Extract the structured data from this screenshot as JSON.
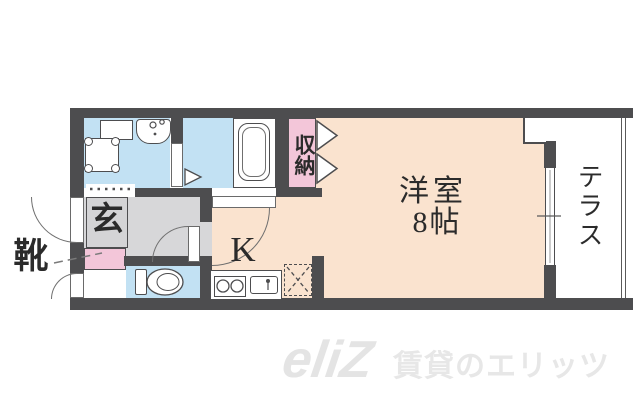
{
  "floorplan": {
    "labels": {
      "entrance": "玄",
      "shoes": "靴",
      "storage": "収納",
      "room_name": "洋室",
      "room_size": "8帖",
      "kitchen": "K",
      "terrace": "テラス"
    },
    "colors": {
      "wall": "#4d4d4f",
      "water_rooms_blue": "#c2e1f3",
      "closet_pink": "#f3c6d9",
      "main_room_cream": "#fae3cf",
      "hall_gray": "#d7d7d9",
      "label_ink": "#2b2b2b",
      "watermark_gray": "#e7e7e7"
    },
    "icons": [
      "washer-pan-icon",
      "washroom-sink-icon",
      "bathtub-icon",
      "toilet-icon",
      "stove-burners-icon",
      "kitchen-sink-icon",
      "refrigerator-space-icon",
      "folding-door-icon",
      "door-swing-icon",
      "sliding-window-icon"
    ]
  },
  "watermark": {
    "logo": "eliZ",
    "text": "賃貸のエリッツ"
  }
}
